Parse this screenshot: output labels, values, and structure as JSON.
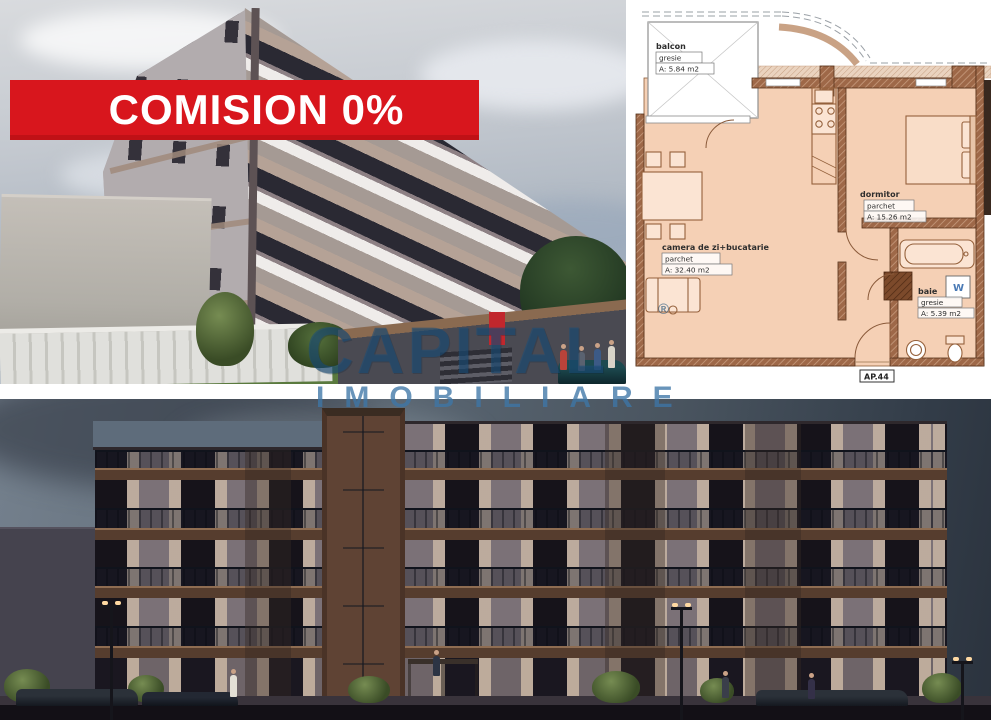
{
  "banner": {
    "text": "COMISION 0%",
    "bg_color": "#d8161d",
    "text_color": "#ffffff"
  },
  "watermark": {
    "line1": "CAPITAL",
    "registered": "®",
    "line2": "IMOBILIARE"
  },
  "floorplan": {
    "apartment_label": "AP.44",
    "washer_label": "W",
    "rooms": {
      "balcony": {
        "name": "balcon",
        "finish": "gresie",
        "area": "A: 5.84 m2"
      },
      "living": {
        "name": "camera de zi+bucatarie",
        "finish": "parchet",
        "area": "A: 32.40 m2"
      },
      "bedroom": {
        "name": "dormitor",
        "finish": "parchet",
        "area": "A: 15.26 m2"
      },
      "bathroom": {
        "name": "baie",
        "finish": "gresie",
        "area": "A: 5.39 m2"
      }
    }
  },
  "colors": {
    "banner_red": "#d8161d",
    "watermark_blue": "#1b507d",
    "plan_room_fill": "#f5d0b5",
    "plan_wall_brown": "#9e6848",
    "facade_slab_brown": "#563d2e",
    "evening_sky": "#4d5b6b"
  }
}
